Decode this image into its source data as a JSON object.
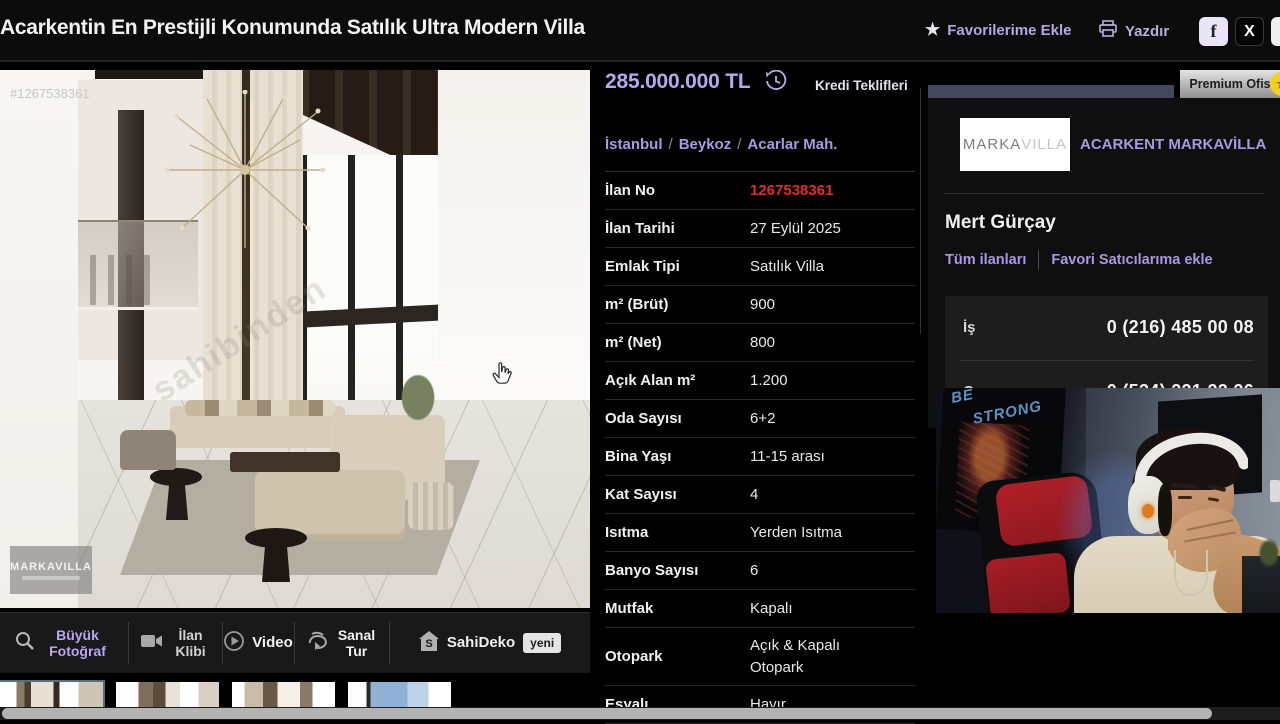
{
  "header": {
    "title": "Acarkentin En Prestijli Konumunda Satılık Ultra Modern Villa",
    "favorite_label": "Favorilerime Ekle",
    "print_label": "Yazdır",
    "facebook_glyph": "f",
    "x_glyph": "X"
  },
  "photo": {
    "listing_id_watermark": "#1267538361",
    "agency_watermark": "MARKAVILLA",
    "diagonal_watermark": "sahibinden",
    "toolbar": [
      {
        "label": "Büyük Fotoğraf"
      },
      {
        "label": "İlan Klibi"
      },
      {
        "label": "Video"
      },
      {
        "label": "Sanal Tur"
      },
      {
        "label": "SahiDeko",
        "badge": "yeni"
      }
    ]
  },
  "listing": {
    "price": "285.000.000 TL",
    "credit_offers_label": "Kredi Teklifleri",
    "breadcrumb": [
      "İstanbul",
      "Beykoz",
      "Acarlar Mah."
    ],
    "breadcrumb_separator": "/",
    "details": [
      {
        "label": "İlan No",
        "value": "1267538361"
      },
      {
        "label": "İlan Tarihi",
        "value": "27 Eylül 2025"
      },
      {
        "label": "Emlak Tipi",
        "value": "Satılık Villa"
      },
      {
        "label": "m² (Brüt)",
        "value": "900"
      },
      {
        "label": "m² (Net)",
        "value": "800"
      },
      {
        "label": "Açık Alan m²",
        "value": "1.200"
      },
      {
        "label": "Oda Sayısı",
        "value": "6+2"
      },
      {
        "label": "Bina Yaşı",
        "value": "11-15 arası"
      },
      {
        "label": "Kat Sayısı",
        "value": "4"
      },
      {
        "label": "Isıtma",
        "value": "Yerden Isıtma"
      },
      {
        "label": "Banyo Sayısı",
        "value": "6"
      },
      {
        "label": "Mutfak",
        "value": "Kapalı"
      },
      {
        "label": "Otopark",
        "value": "Açık & Kapalı Otopark"
      },
      {
        "label": "Eşyalı",
        "value": "Hayır"
      }
    ]
  },
  "agency": {
    "premium_badge": "Premium Ofis",
    "logo_part1": "MARKA",
    "logo_part2": "VILLA",
    "name": "ACARKENT MARKAVİLLA",
    "agent": "Mert Gürçay",
    "links": [
      "Tüm ilanları",
      "Favori Satıcılarıma ekle"
    ],
    "phones": [
      {
        "type": "İş",
        "number": "0 (216) 485 00 08"
      },
      {
        "type": "Cep",
        "number": "0 (534) 221 22 26"
      }
    ]
  },
  "webcam": {
    "poster_line1": "BE",
    "poster_line2": "STRONG"
  },
  "colors": {
    "accent_purple": "#b5a8ec",
    "link_purple": "#a999e2",
    "highlight_red": "#e02d2d",
    "premium_gray": "#bdbdbd",
    "slate_bar": "#45475f"
  }
}
